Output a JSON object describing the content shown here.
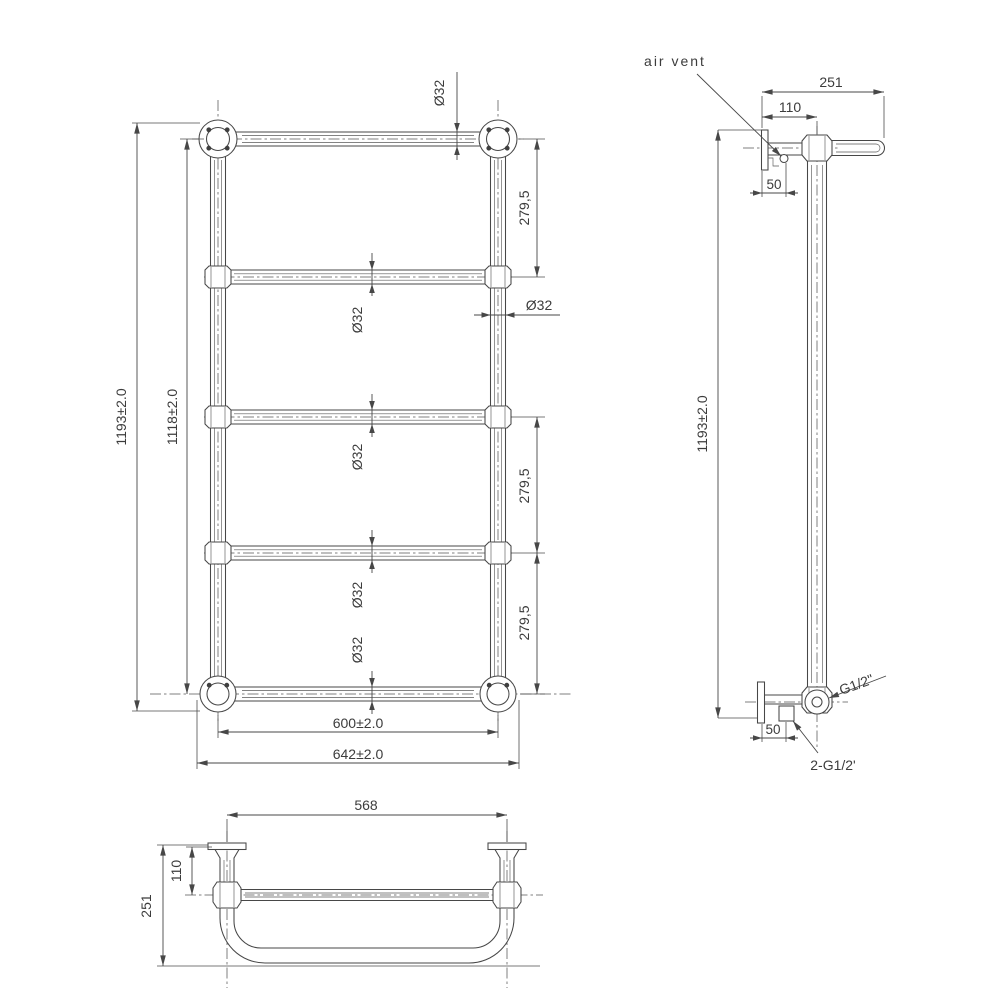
{
  "drawing": {
    "colors": {
      "ink": "#3c3c3c",
      "line": "#474747",
      "background": "#ffffff"
    },
    "front_view": {
      "dim_height_overall": "1193±2.0",
      "dim_height_centers": "1118±2.0",
      "dim_spacing_top": "279,5",
      "dim_spacing_mid": "279,5",
      "dim_spacing_bottom": "279,5",
      "dim_dia_top_bar": "Ø32",
      "dim_dia_right_post": "Ø32",
      "dim_dia_bar2": "Ø32",
      "dim_dia_bar3": "Ø32",
      "dim_dia_bar4": "Ø32",
      "dim_dia_bar5": "Ø32",
      "dim_width_centers": "600±2.0",
      "dim_width_overall": "642±2.0"
    },
    "side_view": {
      "label_air_vent": "air vent",
      "dim_depth_overall": "251",
      "dim_bracket_offset": "110",
      "dim_bracket_top": "50",
      "dim_height_overall": "1193±2.0",
      "label_thread_top": "G1/2\"",
      "dim_bracket_bottom": "50",
      "label_thread_bottom": "2-G1/2'"
    },
    "bottom_view": {
      "dim_width_brackets": "568",
      "dim_bracket_offset": "110",
      "dim_depth_overall": "251"
    }
  }
}
